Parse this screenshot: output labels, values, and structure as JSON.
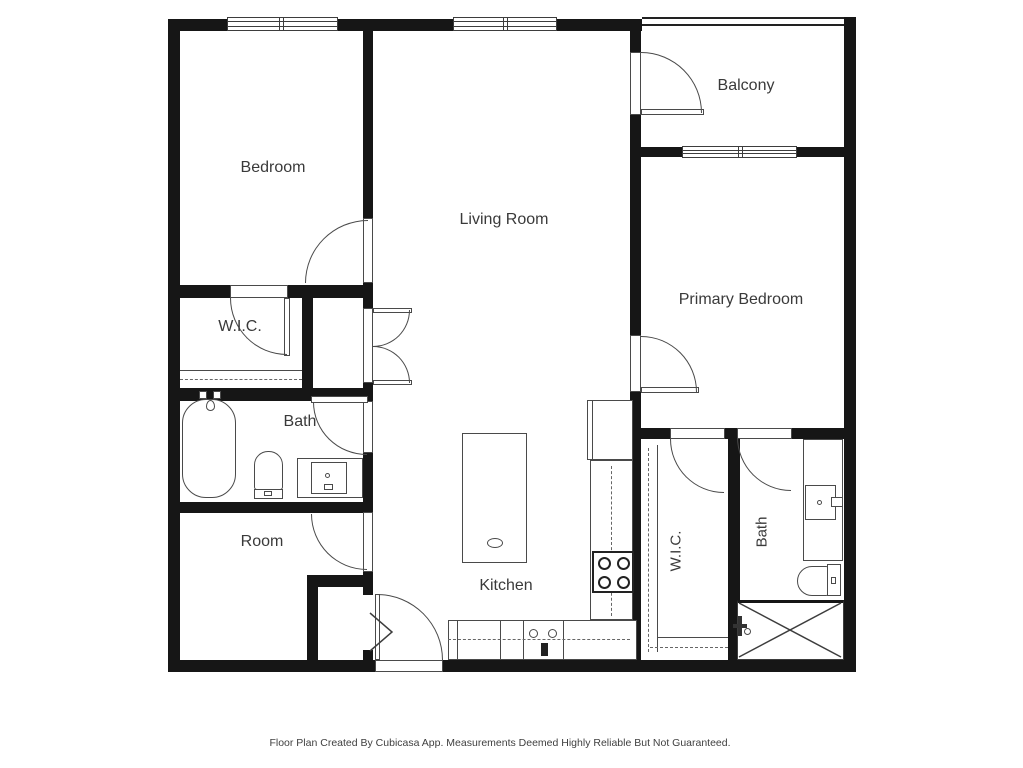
{
  "page": {
    "background": "#ffffff"
  },
  "plan": {
    "wall_color": "#161616",
    "line_color": "#4a4a4a",
    "text_color": "#3a3a3a",
    "rooms": {
      "bedroom": {
        "label": "Bedroom"
      },
      "living_room": {
        "label": "Living Room"
      },
      "balcony": {
        "label": "Balcony"
      },
      "primary_bedroom": {
        "label": "Primary Bedroom"
      },
      "wic_upper_left": {
        "label": "W.I.C."
      },
      "bath_upper_left": {
        "label": "Bath"
      },
      "room": {
        "label": "Room"
      },
      "kitchen": {
        "label": "Kitchen"
      },
      "wic_lower_right": {
        "label": "W.I.C."
      },
      "bath_lower_right": {
        "label": "Bath"
      }
    },
    "fixtures": [
      "bathtub",
      "toilet",
      "vanity-sink",
      "kitchen-island",
      "refrigerator",
      "stove",
      "kitchen-sink",
      "shower",
      "bifold-door",
      "closet-rod",
      "closet-shelf"
    ]
  },
  "footer": {
    "text": "Floor Plan Created By Cubicasa App. Measurements Deemed Highly Reliable But Not Guaranteed."
  }
}
